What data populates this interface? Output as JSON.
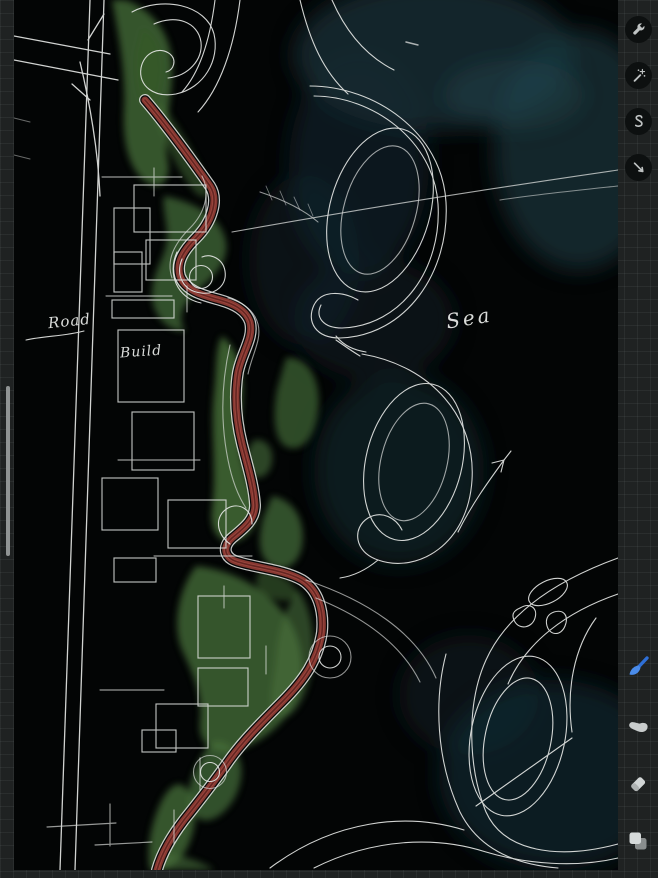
{
  "background": {
    "color": "#1f2222",
    "grid_line_color": "#2b2e2e",
    "grid_cell_px": 13
  },
  "canvas": {
    "bg_color": "#030505",
    "labels": {
      "road": "Road",
      "build": "Build",
      "sea": "Sea"
    },
    "palette": {
      "sketch_white": "#e4e6e4",
      "vegetation_green": "#47703a",
      "path_red": "#8c3a33",
      "sea_teal": "#17343b"
    }
  },
  "left_sidebar": {
    "slider_color": "#8f9393"
  },
  "toolbar": {
    "top_tools": [
      {
        "id": "actions",
        "icon": "wrench-icon"
      },
      {
        "id": "adjustments",
        "icon": "magic-wand-icon"
      },
      {
        "id": "selection",
        "icon": "s-curve-icon"
      },
      {
        "id": "transform",
        "icon": "arrow-icon"
      }
    ],
    "bottom_tools": [
      {
        "id": "paint",
        "icon": "paintbrush-icon",
        "active": true,
        "accent_color": "#3f83e8"
      },
      {
        "id": "smudge",
        "icon": "smudge-finger-icon",
        "active": false
      },
      {
        "id": "erase",
        "icon": "eraser-icon",
        "active": false
      },
      {
        "id": "layers",
        "icon": "layers-icon",
        "active": false
      }
    ]
  }
}
